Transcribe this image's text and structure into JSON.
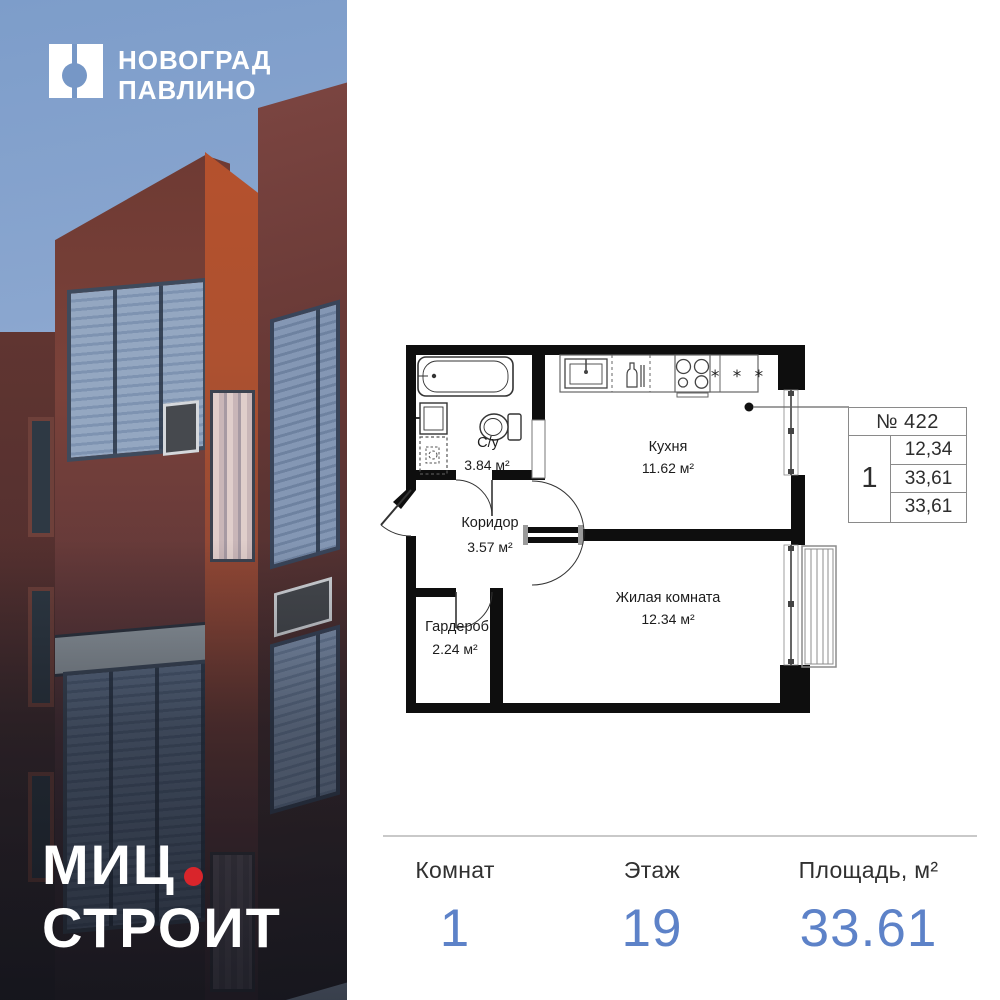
{
  "brand": {
    "logo_line1": "НОВОГРАД",
    "logo_line2": "ПАВЛИНО",
    "developer_word1": "МИЦ",
    "developer_word2": "СТРОИТ"
  },
  "plan": {
    "rooms": {
      "bathroom": {
        "name": "С/у",
        "area": "3.84 м²"
      },
      "kitchen": {
        "name": "Кухня",
        "area": "11.62 м²"
      },
      "corridor": {
        "name": "Коридор",
        "area": "3.57 м²"
      },
      "wardrobe": {
        "name": "Гардероб",
        "area": "2.24 м²"
      },
      "living": {
        "name": "Жилая комната",
        "area": "12.34 м²"
      }
    },
    "fridge_symbol": "* * *"
  },
  "info_table": {
    "header": "№ 422",
    "rooms": "1",
    "values": [
      "12,34",
      "33,61",
      "33,61"
    ]
  },
  "summary": {
    "rooms_label": "Комнат",
    "rooms_value": "1",
    "floor_label": "Этаж",
    "floor_value": "19",
    "area_label": "Площадь, м²",
    "area_value": "33.61"
  },
  "colors": {
    "value_blue": "#5d82c8",
    "accent_red": "#d9252b",
    "sky_blue": "#7697c6"
  }
}
